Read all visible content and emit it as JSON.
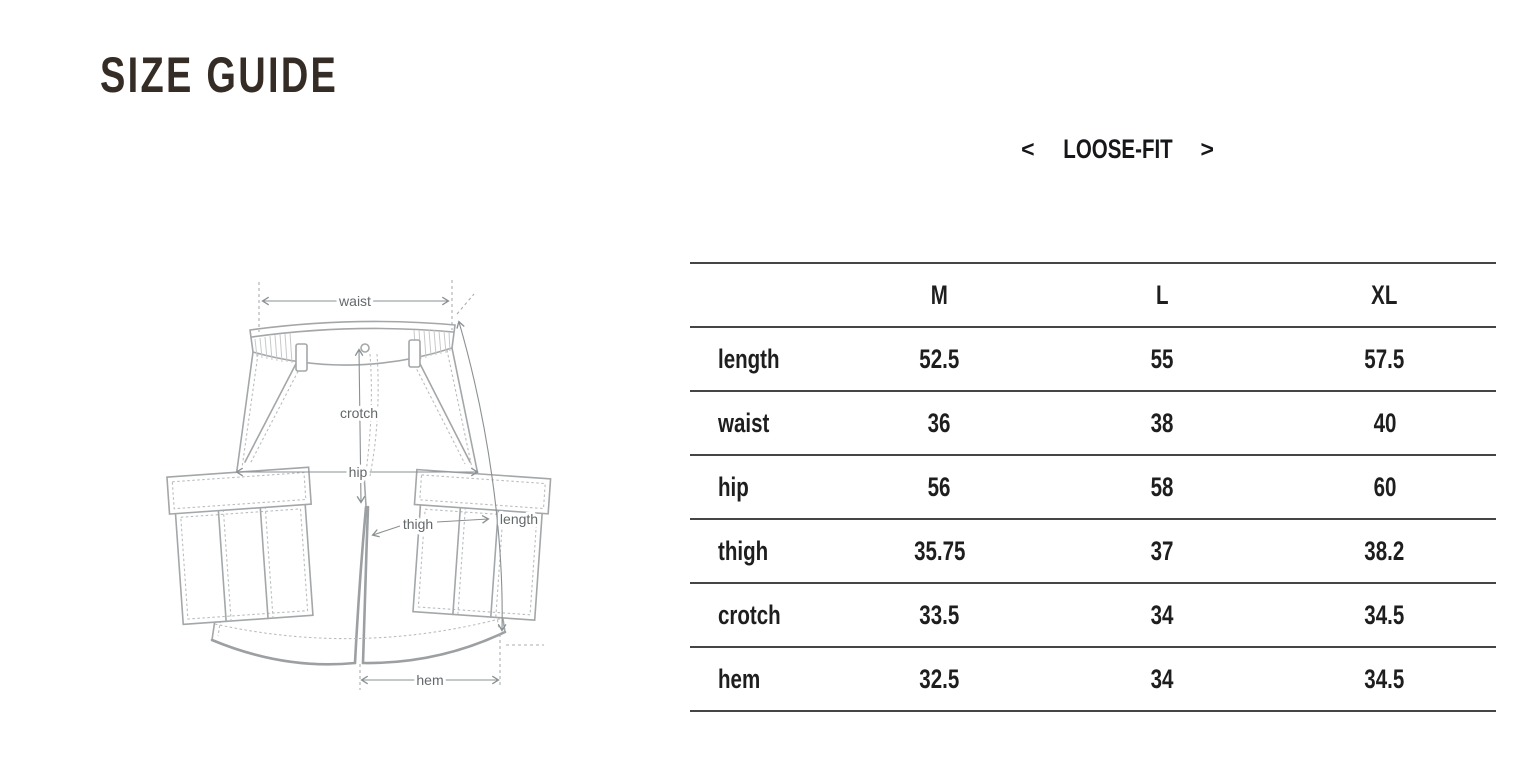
{
  "page": {
    "title": "SIZE GUIDE"
  },
  "fit_selector": {
    "prev_icon": "<",
    "label": "LOOSE-FIT",
    "next_icon": ">"
  },
  "diagram": {
    "labels": {
      "waist": "waist",
      "crotch": "crotch",
      "hip": "hip",
      "thigh": "thigh",
      "length": "length",
      "hem": "hem"
    }
  },
  "size_table": {
    "columns": [
      "",
      "M",
      "L",
      "XL"
    ],
    "rows": [
      {
        "label": "length",
        "values": [
          "52.5",
          "55",
          "57.5"
        ]
      },
      {
        "label": "waist",
        "values": [
          "36",
          "38",
          "40"
        ]
      },
      {
        "label": "hip",
        "values": [
          "56",
          "58",
          "60"
        ]
      },
      {
        "label": "thigh",
        "values": [
          "35.75",
          "37",
          "38.2"
        ]
      },
      {
        "label": "crotch",
        "values": [
          "33.5",
          "34",
          "34.5"
        ]
      },
      {
        "label": "hem",
        "values": [
          "32.5",
          "34",
          "34.5"
        ]
      }
    ]
  },
  "colors": {
    "title_text": "#352c25",
    "table_text": "#1e1e1e",
    "table_border": "#454545",
    "garment_line": "#a3a7a9",
    "annotation_text": "#63686b"
  }
}
